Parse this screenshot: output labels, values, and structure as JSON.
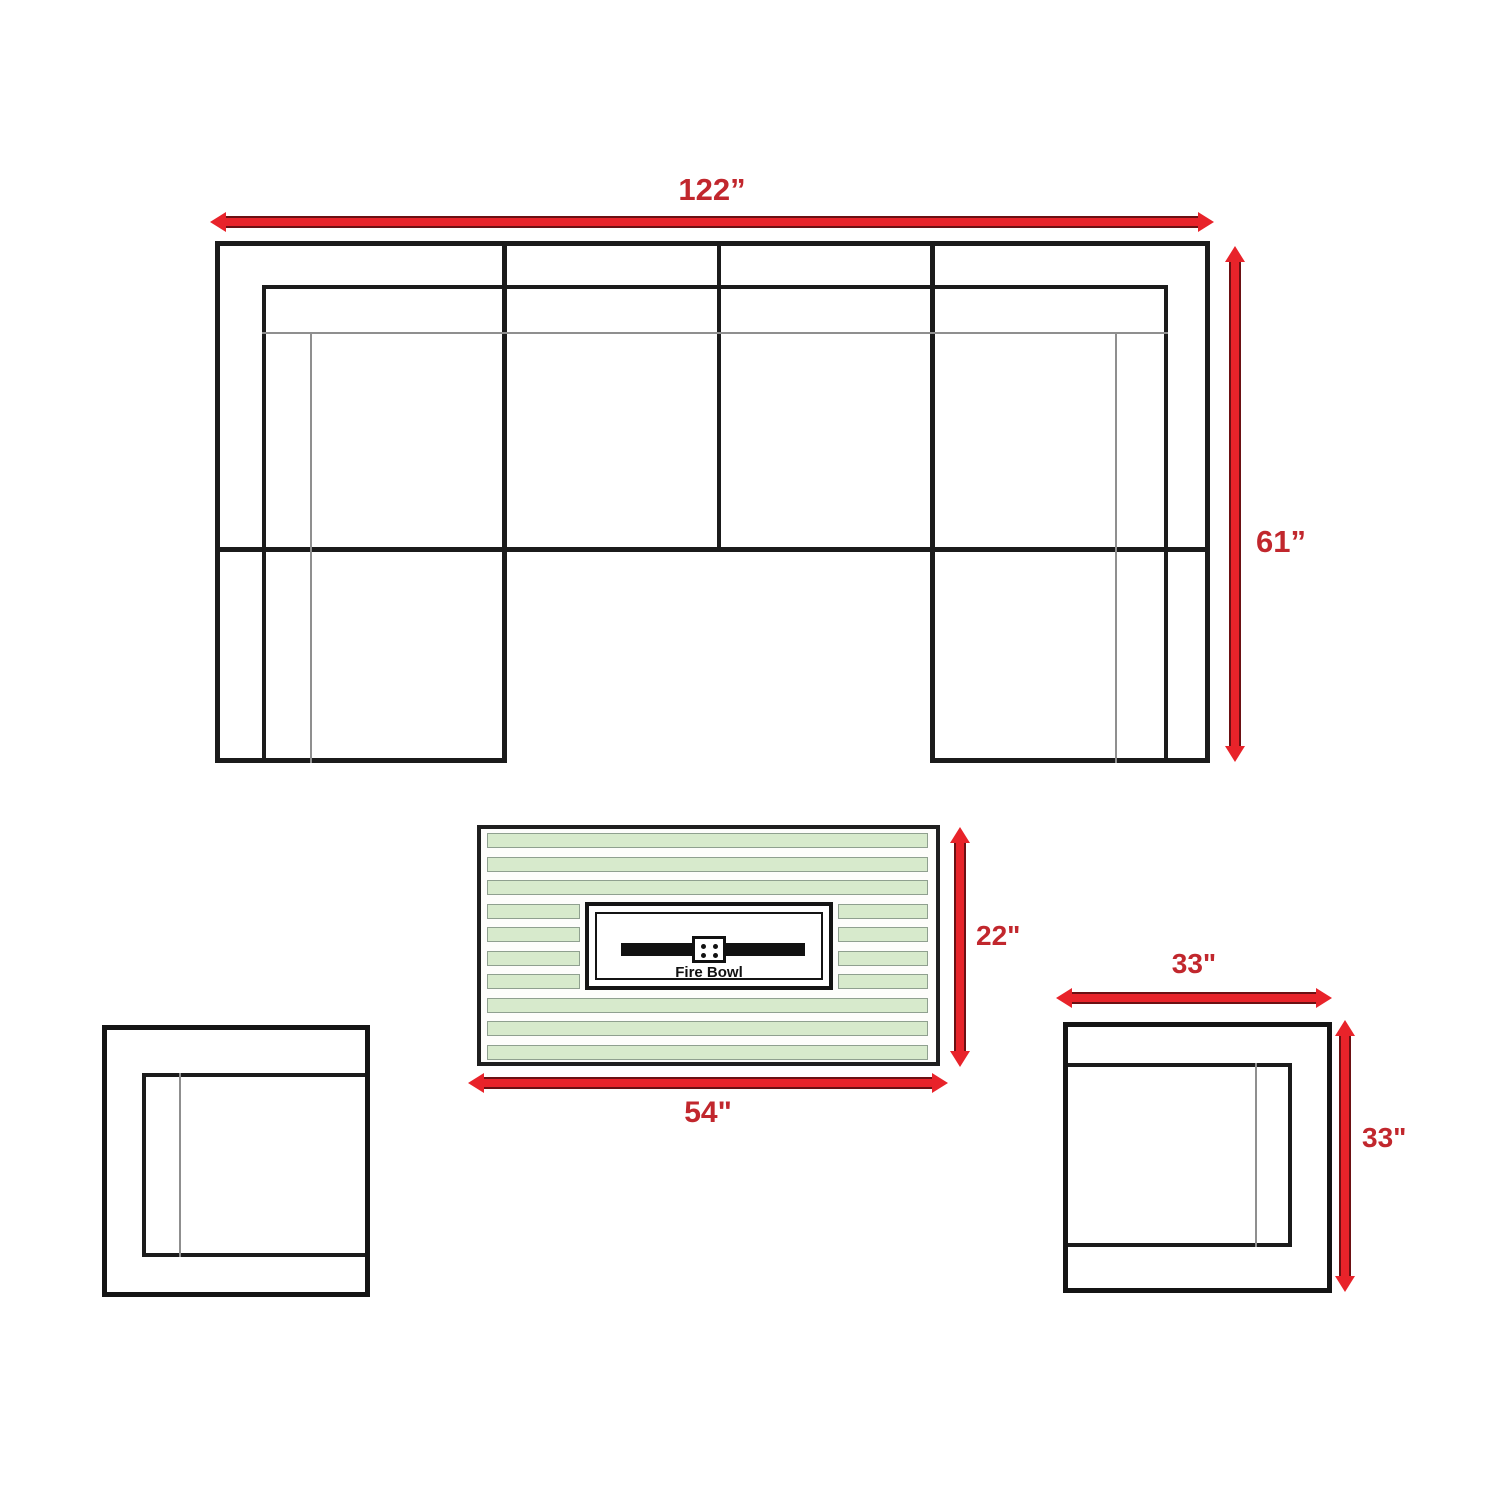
{
  "colors": {
    "arrow_red": "#e8232a",
    "label_red": "#c1272d",
    "line_black": "#1b1b1b",
    "thin_gray": "#8f8f8f",
    "slat_green": "#d7eacc",
    "slat_border": "#8fa08f",
    "background": "#ffffff"
  },
  "sofa": {
    "width_label": "122”",
    "depth_label": "61”"
  },
  "fire_table": {
    "depth_label": "22\"",
    "width_label": "54\"",
    "bowl_label": "Fire Bowl"
  },
  "chair": {
    "width_label": "33\"",
    "depth_label": "33\""
  }
}
